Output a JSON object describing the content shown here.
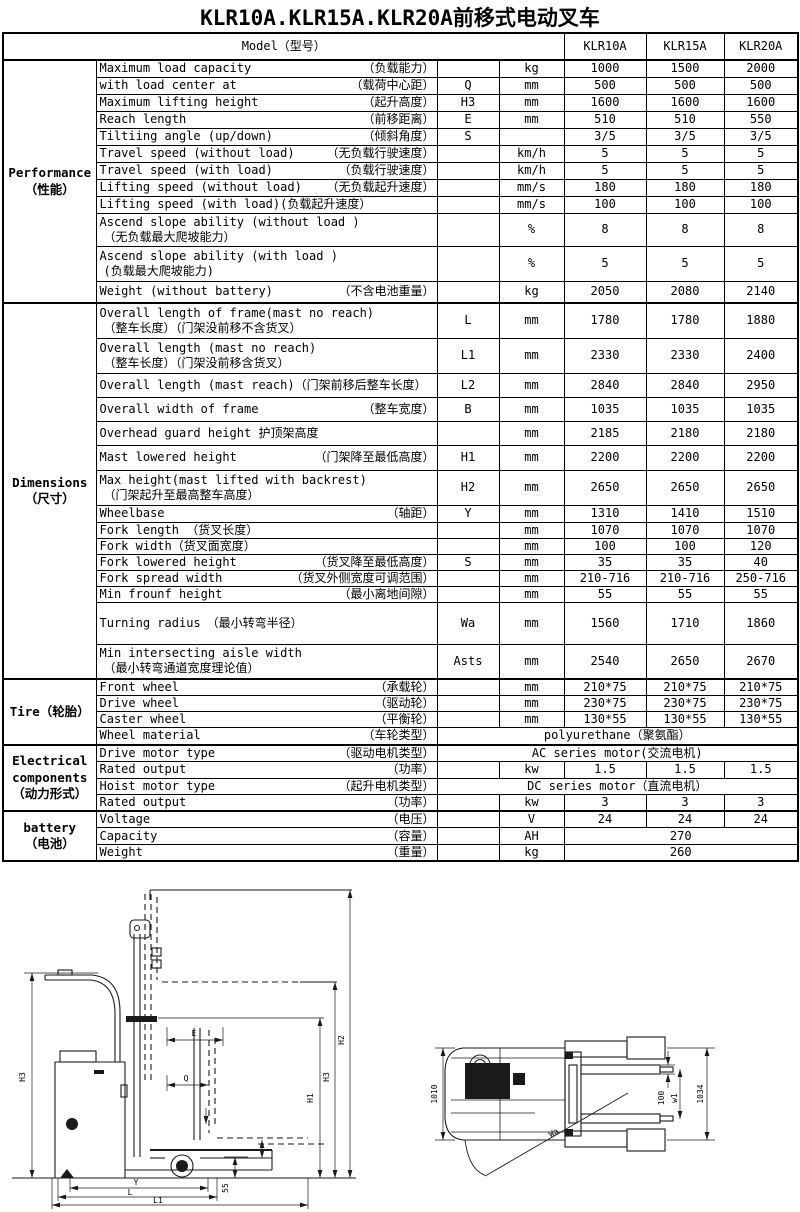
{
  "title": "KLR10A.KLR15A.KLR20A前移式电动叉车",
  "table": {
    "model_label": "Model（型号）",
    "models": [
      "KLR10A",
      "KLR15A",
      "KLR20A"
    ],
    "sections": [
      {
        "label": [
          "Performance",
          "（性能）"
        ],
        "rows": [
          {
            "en": "Maximum load capacity",
            "cn": "（负载能力）",
            "sym": "",
            "unit": "kg",
            "vals": [
              "1000",
              "1500",
              "2000"
            ],
            "h": 17
          },
          {
            "en": "with load center at",
            "cn": "（载荷中心距）",
            "sym": "Q",
            "unit": "mm",
            "vals": [
              "500",
              "500",
              "500"
            ],
            "h": 17
          },
          {
            "en": "Maximum lifting height",
            "cn": "（起升高度）",
            "sym": "H3",
            "unit": "mm",
            "vals": [
              "1600",
              "1600",
              "1600"
            ],
            "h": 17
          },
          {
            "en": "Reach length",
            "cn": "（前移距离）",
            "sym": "E",
            "unit": "mm",
            "vals": [
              "510",
              "510",
              "550"
            ],
            "h": 17
          },
          {
            "en": "Tiltiing angle (up/down)",
            "cn": "（倾斜角度）",
            "sym": "S",
            "unit": "",
            "vals": [
              "3/5",
              "3/5",
              "3/5"
            ],
            "h": 17
          },
          {
            "en": "Travel speed (without load)",
            "cn": "（无负载行驶速度）",
            "sym": "",
            "unit": "km/h",
            "vals": [
              "5",
              "5",
              "5"
            ],
            "h": 17
          },
          {
            "en": "Travel speed (with load)",
            "cn": "（负载行驶速度）",
            "sym": "",
            "unit": "km/h",
            "vals": [
              "5",
              "5",
              "5"
            ],
            "h": 17
          },
          {
            "en": "Lifting speed (without load)",
            "cn": "（无负载起升速度）",
            "sym": "",
            "unit": "mm/s",
            "vals": [
              "180",
              "180",
              "180"
            ],
            "h": 17
          },
          {
            "en": "Lifting speed (with load)(负载起升速度）",
            "cn": "",
            "sym": "",
            "unit": "mm/s",
            "vals": [
              "100",
              "100",
              "100"
            ],
            "h": 17
          },
          {
            "en": "Ascend slope ability (without load )",
            "cn": "（无负载最大爬坡能力）",
            "two": true,
            "sym": "",
            "unit": "%",
            "vals": [
              "8",
              "8",
              "8"
            ],
            "h": 33
          },
          {
            "en": "Ascend slope ability (with load )",
            "cn": "(负载最大爬坡能力)",
            "two": true,
            "sym": "",
            "unit": "%",
            "vals": [
              "5",
              "5",
              "5"
            ],
            "h": 35
          },
          {
            "en": "Weight (without battery)",
            "cn": "（不含电池重量）",
            "sym": "",
            "unit": "kg",
            "vals": [
              "2050",
              "2080",
              "2140"
            ],
            "h": 22
          }
        ]
      },
      {
        "label": [
          "Dimensions",
          "（尺寸）"
        ],
        "rows": [
          {
            "en": "Overall length of frame(mast no reach)",
            "cn": "（整车长度）（门架没前移不含货叉）",
            "two": true,
            "sym": "L",
            "unit": "mm",
            "vals": [
              "1780",
              "1780",
              "1880"
            ],
            "h": 35
          },
          {
            "en": "Overall length (mast no reach)",
            "cn": "（整车长度）（门架没前移含货叉）",
            "two": true,
            "sym": "L1",
            "unit": "mm",
            "vals": [
              "2330",
              "2330",
              "2400"
            ],
            "h": 35
          },
          {
            "en": "Overall length (mast reach)（门架前移后整车长度）",
            "cn": "",
            "sym": "L2",
            "unit": "mm",
            "vals": [
              "2840",
              "2840",
              "2950"
            ],
            "h": 24
          },
          {
            "en": "Overall width of frame",
            "cn": "（整车宽度）",
            "sym": "B",
            "unit": "mm",
            "vals": [
              "1035",
              "1035",
              "1035"
            ],
            "h": 24
          },
          {
            "en": "Overhead guard height 护顶架高度",
            "cn": "",
            "sym": "",
            "unit": "mm",
            "vals": [
              "2185",
              "2180",
              "2180"
            ],
            "h": 24
          },
          {
            "en": "Mast lowered height",
            "cn": "（门架降至最低高度）",
            "sym": "H1",
            "unit": "mm",
            "vals": [
              "2200",
              "2200",
              "2200"
            ],
            "h": 25
          },
          {
            "en": "Max height(mast lifted with backrest)",
            "cn": "（门架起升至最高整车高度）",
            "two": true,
            "sym": "H2",
            "unit": "mm",
            "vals": [
              "2650",
              "2650",
              "2650"
            ],
            "h": 35
          },
          {
            "en": "Wheelbase",
            "cn": "（轴距）",
            "sym": "Y",
            "unit": "mm",
            "vals": [
              "1310",
              "1410",
              "1510"
            ],
            "h": 17
          },
          {
            "en": "Fork length （货叉长度）",
            "cn": "",
            "sym": "",
            "unit": "mm",
            "vals": [
              "1070",
              "1070",
              "1070"
            ],
            "h": 16
          },
          {
            "en": "Fork width（货叉面宽度）",
            "cn": "",
            "sym": "",
            "unit": "mm",
            "vals": [
              "100",
              "100",
              "120"
            ],
            "h": 16
          },
          {
            "en": "Fork lowered height",
            "cn": "（货叉降至最低高度）",
            "sym": "S",
            "unit": "mm",
            "vals": [
              "35",
              "35",
              "40"
            ],
            "h": 16
          },
          {
            "en": "Fork spread width",
            "cn": "（货叉外侧宽度可调范围）",
            "sym": "",
            "unit": "mm",
            "vals": [
              "210-716",
              "210-716",
              "250-716"
            ],
            "h": 16
          },
          {
            "en": "Min frounf height",
            "cn": "（最小离地间隙）",
            "sym": "",
            "unit": "mm",
            "vals": [
              "55",
              "55",
              "55"
            ],
            "h": 16
          },
          {
            "en": "Turning radius　（最小转弯半径）",
            "cn": "",
            "sym": "Wa",
            "unit": "mm",
            "vals": [
              "1560",
              "1710",
              "1860"
            ],
            "h": 42
          },
          {
            "en": "Min intersecting aisle width",
            "cn": "（最小转弯通道宽度理论值）",
            "two": true,
            "sym": "Asts",
            "unit": "mm",
            "vals": [
              "2540",
              "2650",
              "2670"
            ],
            "h": 35
          }
        ]
      },
      {
        "label": [
          "Tire（轮胎）"
        ],
        "rows": [
          {
            "en": "Front wheel",
            "cn": "（承载轮）",
            "sym": "",
            "unit": "mm",
            "vals": [
              "210*75",
              "210*75",
              "210*75"
            ],
            "h": 16
          },
          {
            "en": "Drive wheel",
            "cn": "（驱动轮）",
            "sym": "",
            "unit": "mm",
            "vals": [
              "230*75",
              "230*75",
              "230*75"
            ],
            "h": 16
          },
          {
            "en": "Caster wheel",
            "cn": "（平衡轮）",
            "sym": "",
            "unit": "mm",
            "vals": [
              "130*55",
              "130*55",
              "130*55"
            ],
            "h": 16
          },
          {
            "en": "Wheel material",
            "cn": "（车轮类型）",
            "span_all": "polyurethane（聚氨酯）",
            "h": 17
          }
        ]
      },
      {
        "label": [
          "Electrical",
          "components",
          "（动力形式）"
        ],
        "rows": [
          {
            "en": "Drive motor type",
            "cn": "（驱动电机类型）",
            "span_all": "AC series motor(交流电机)",
            "h": 16
          },
          {
            "en": "Rated output",
            "cn": "（功率）",
            "sym": "",
            "unit": "kw",
            "vals": [
              "1.5",
              "1.5",
              "1.5"
            ],
            "h": 17
          },
          {
            "en": "Hoist motor type",
            "cn": "（起升电机类型）",
            "span_all": "DC series motor（直流电机）",
            "h": 16
          },
          {
            "en": "Rated output",
            "cn": "（功率）",
            "sym": "",
            "unit": "kw",
            "vals": [
              "3",
              "3",
              "3"
            ],
            "h": 17
          }
        ]
      },
      {
        "label": [
          "battery",
          "（电池）"
        ],
        "rows": [
          {
            "en": "Voltage",
            "cn": "（电压）",
            "sym": "",
            "unit": "V",
            "vals": [
              "24",
              "24",
              "24"
            ],
            "h": 16
          },
          {
            "en": "Capacity",
            "cn": "（容量）",
            "sym": "",
            "unit": "AH",
            "span_vals": "270",
            "h": 17
          },
          {
            "en": "Weight",
            "cn": "（重量）",
            "sym": "",
            "unit": "kg",
            "span_vals": "260",
            "h": 16
          }
        ]
      }
    ]
  },
  "diagrams": {
    "side": {
      "h3_left": "H3",
      "e": "E",
      "q": "Q",
      "h1": "H1",
      "h3_right": "H3",
      "h2": "H2",
      "y": "Y",
      "l": "L",
      "l1": "L1",
      "clearance": "55"
    },
    "top": {
      "width_left": "1010",
      "fork_width": "100",
      "w1": "w1",
      "width_right": "1034",
      "turning": "Wa"
    }
  }
}
